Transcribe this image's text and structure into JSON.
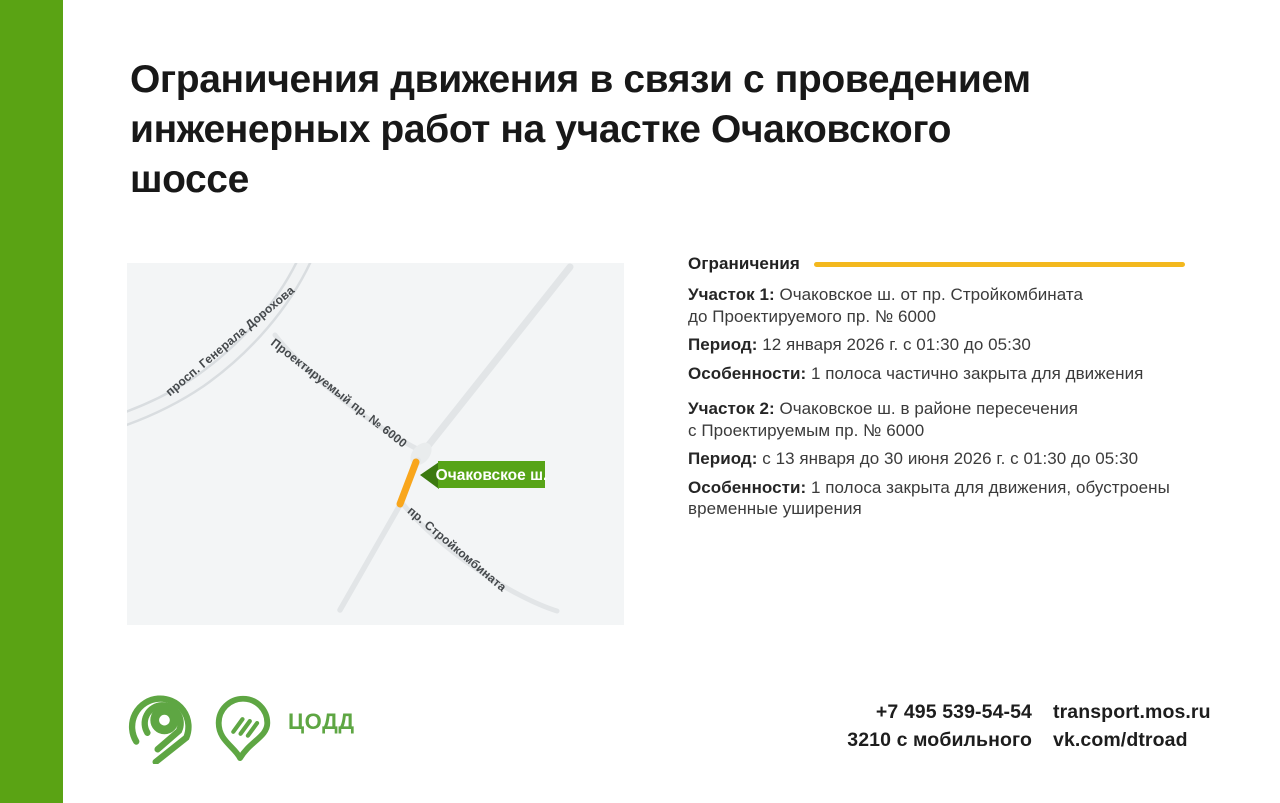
{
  "page": {
    "title": "Ограничения движения в связи с проведением\nинженерных работ на участке Очаковского\nшоссе"
  },
  "colors": {
    "sidebar_green": "#5aa314",
    "logo_green": "#5ea643",
    "accent_yellow": "#f3b81e",
    "map_highlight_orange": "#f9a61c",
    "map_label_green": "#57a417"
  },
  "map": {
    "road_labels": {
      "dorohova": "просп. Генерала Дорохова",
      "proektiruemy": "Проектируемый пр. № 6000",
      "stroykombinata": "пр. Стройкомбината"
    },
    "highlight_label": "Очаковское ш."
  },
  "restrictions": {
    "heading": "Ограничения",
    "sections": [
      {
        "site_label": "Участок 1:",
        "site_text": " Очаковское ш. от пр. Стройкомбината\nдо Проектируемого пр. № 6000",
        "period_label": "Период:",
        "period_text": " 12 января 2026 г. с 01:30 до 05:30",
        "features_label": "Особенности:",
        "features_text": " 1 полоса частично закрыта для движения"
      },
      {
        "site_label": "Участок 2:",
        "site_text": " Очаковское ш. в районе пересечения\nс Проектируемым пр. № 6000",
        "period_label": "Период:",
        "period_text": " с 13 января до 30 июня 2026 г. с 01:30 до 05:30",
        "features_label": "Особенности:",
        "features_text": " 1 полоса закрыта для движения, обустроены\nвременные уширения"
      }
    ]
  },
  "footer": {
    "brand": "ЦОДД",
    "phone_main": "+7 495 539-54-54",
    "phone_mobile": "3210 с мобильного",
    "website": "transport.mos.ru",
    "social": "vk.com/dtroad"
  }
}
